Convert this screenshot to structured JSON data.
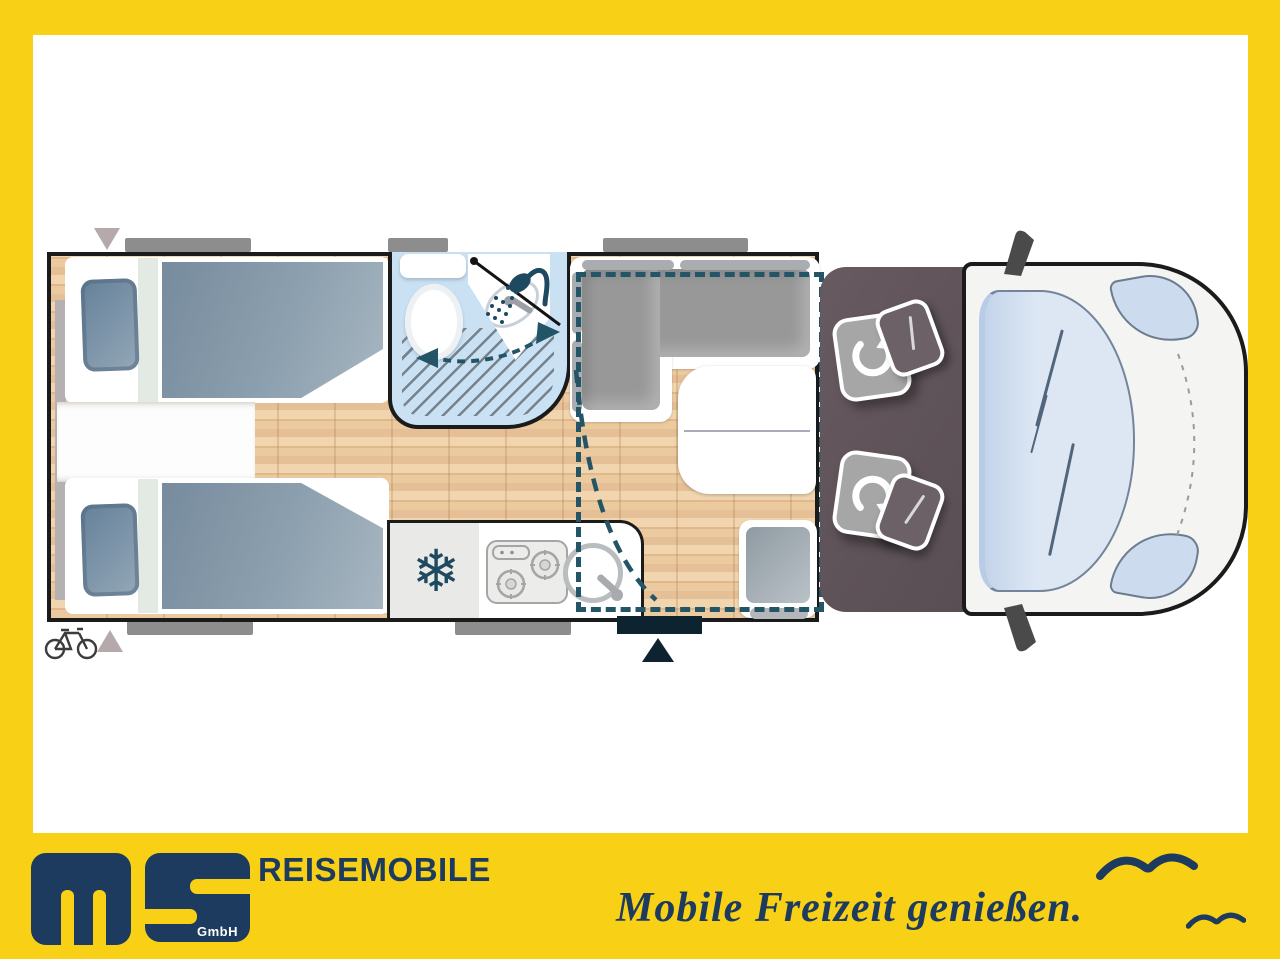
{
  "branding": {
    "logo": {
      "letter_m": "m",
      "letter_s": "S",
      "suffix": "GmbH"
    },
    "company_line": "REISEMOBILE",
    "tagline": "Mobile Freizeit genießen."
  },
  "colors": {
    "frame_yellow": "#F8D117",
    "brand_navy": "#1D3A5F",
    "plan_outline": "#1B1B1B",
    "floor_wood": "#E5BF95",
    "bathroom_blue": "#C9E1F3",
    "textile_slate": "#8296A7",
    "cab_gray": "#5D5359",
    "dashed_teal": "#235566",
    "window_gray": "#8D8D8D",
    "entry_dark": "#0D2330"
  },
  "floorplan": {
    "view": "motorhome top view",
    "zones": [
      {
        "id": "twin-beds",
        "label": "two single beds with pillows (rear)"
      },
      {
        "id": "bathroom",
        "label": "bathroom with toilet, corner basin, swivel shower wall"
      },
      {
        "id": "kitchen",
        "label": "kitchen block with fridge, two-burner hob and round sink"
      },
      {
        "id": "dinette",
        "label": "L-shaped seating group with table and side seat"
      },
      {
        "id": "drop-down-bed",
        "label": "drop-down bed shown as dashed rectangle"
      },
      {
        "id": "cab",
        "label": "driver cab with two swivel seats"
      },
      {
        "id": "entrance",
        "label": "entrance door with step and arrow marker"
      }
    ],
    "icons": {
      "snowflake": {
        "name": "snowflake-icon",
        "glyph": "❄"
      },
      "shower": {
        "name": "shower-icon"
      },
      "bicycle": {
        "name": "bicycle-icon"
      },
      "swivel": {
        "name": "swivel-seat-arrow-icon"
      },
      "entry": {
        "name": "entry-arrow-icon"
      },
      "window": {
        "name": "window-marker"
      },
      "bird": {
        "name": "seagull-icon"
      }
    }
  }
}
